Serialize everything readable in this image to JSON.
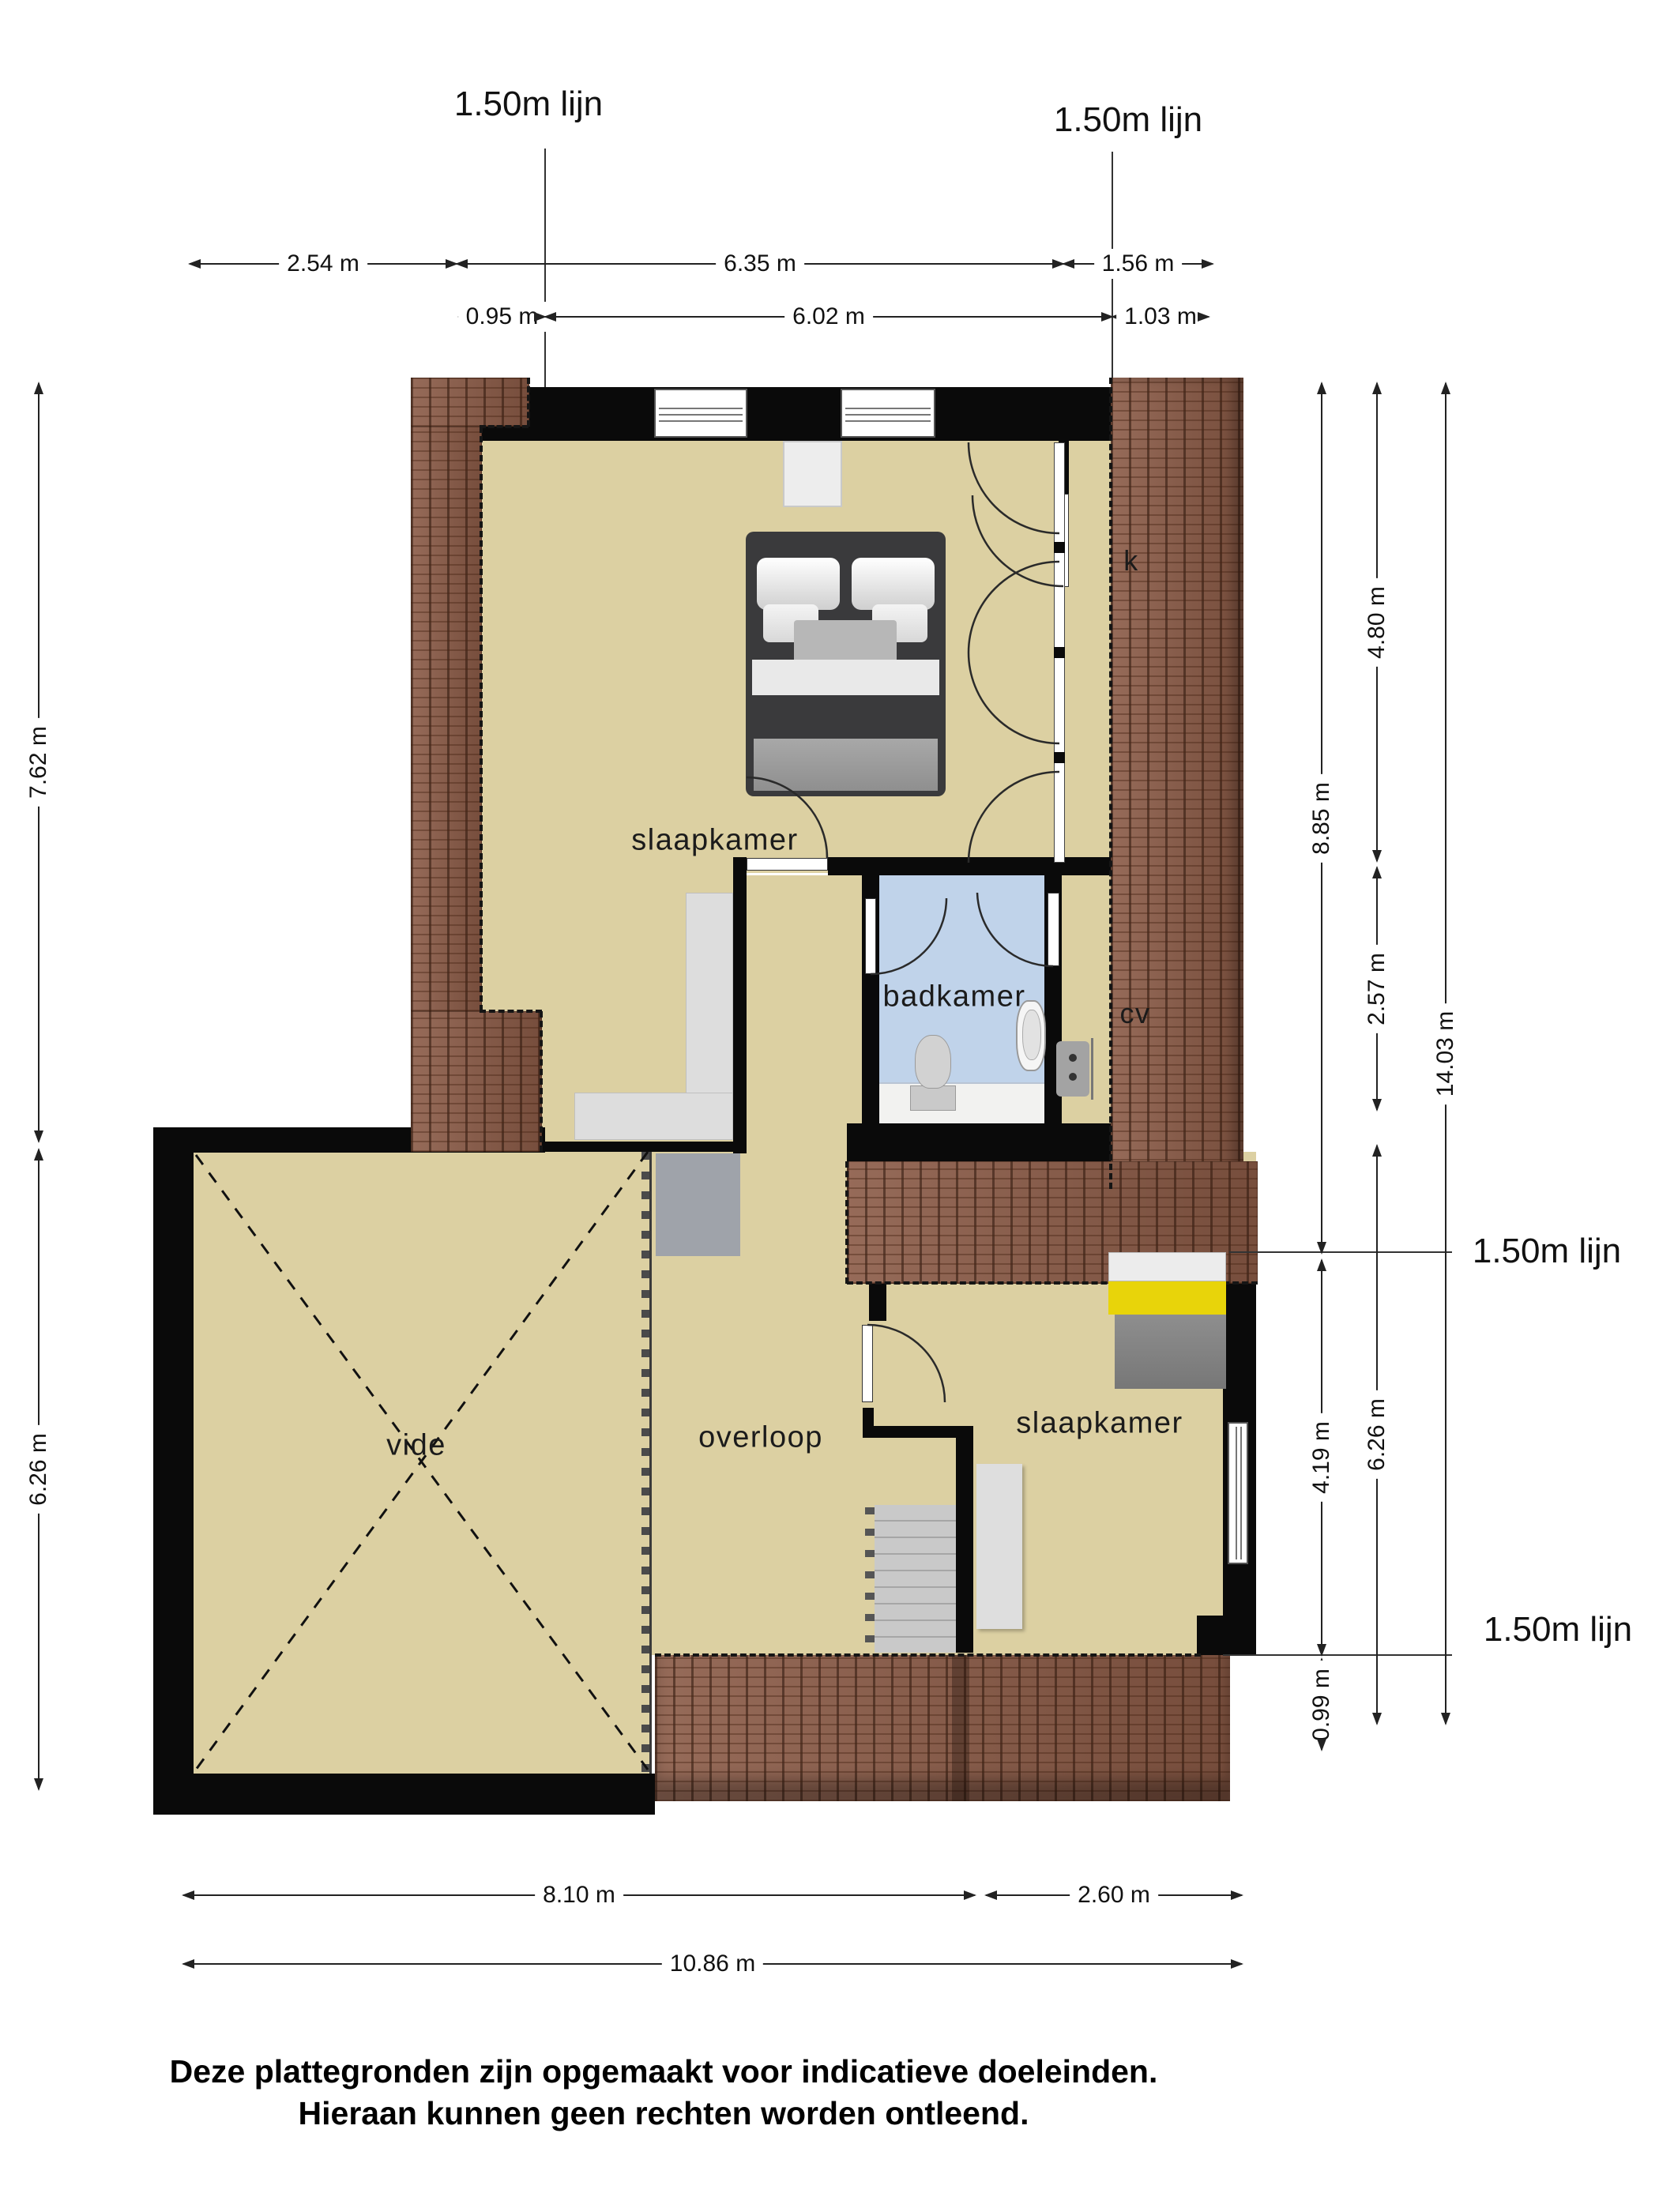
{
  "line_labels": {
    "top_left": "1.50m lijn",
    "top_right": "1.50m lijn",
    "mid_right": "1.50m lijn",
    "bottom_right": "1.50m lijn"
  },
  "dims": {
    "d254": "2.54 m",
    "d635": "6.35 m",
    "d156": "1.56 m",
    "d095": "0.95 m",
    "d602": "6.02 m",
    "d103": "1.03 m",
    "d762": "7.62 m",
    "d626l": "6.26 m",
    "d885": "8.85 m",
    "d419": "4.19 m",
    "d099": "0.99 m",
    "d480": "4.80 m",
    "d257": "2.57 m",
    "d626r": "6.26 m",
    "d1403": "14.03 m",
    "d810": "8.10 m",
    "d260": "2.60 m",
    "d1086": "10.86 m"
  },
  "rooms": {
    "slaapkamer_main": "slaapkamer",
    "badkamer": "badkamer",
    "cv": "cv",
    "k": "k",
    "vide": "vide",
    "overloop": "overloop",
    "slaapkamer_2": "slaapkamer"
  },
  "disclaimer": {
    "line1": "Deze plattegronden zijn opgemaakt voor indicatieve doeleinden.",
    "line2": "Hieraan kunnen geen rechten worden ontleend."
  },
  "colors": {
    "floor": "#dcd0a2",
    "wall": "#0a0a0a",
    "roof": "#8a5a46",
    "bathroom_floor": "#c0d3ea",
    "bed_yellow": "#e8d40a",
    "stairs": "#c9c9c9"
  }
}
